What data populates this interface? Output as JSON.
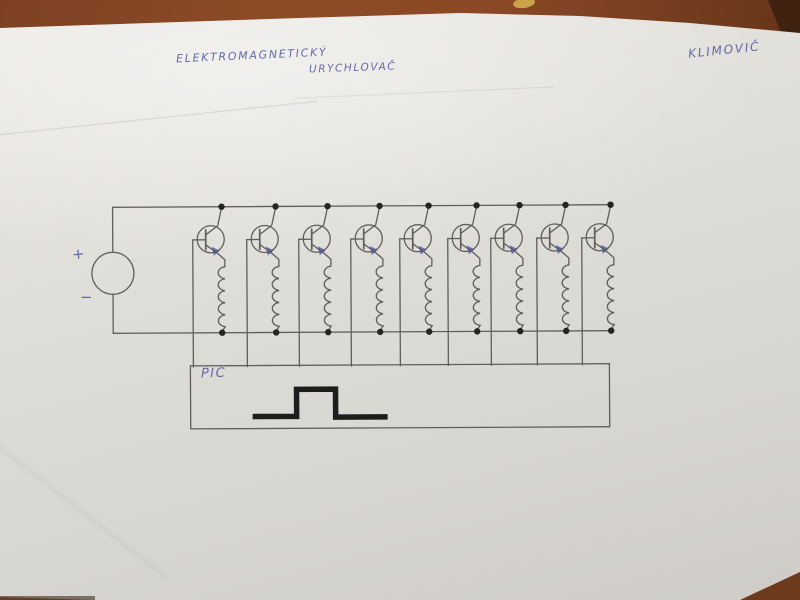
{
  "photo": {
    "title_line1": "ELEKTROMAGNETICKÝ",
    "title_line2": "URYCHLOVAČ",
    "author_signature": "KLIMOVIČ",
    "ink_color": "#4d53a0",
    "pencil_color": "#5f5e5a",
    "paper_color": "#dcdad5",
    "table_color": "#8a4a28"
  },
  "circuit": {
    "type": "hand-drawn schematic",
    "description": "DC source driving 9 parallel transistor-coil stages, bases controlled by a PIC pulse generator",
    "source": {
      "plus_label": "+",
      "minus_label": "−"
    },
    "controller_label": "PIC",
    "stage_count": 9,
    "stage_x": [
      222,
      276,
      328,
      380,
      429,
      477,
      520,
      566,
      611
    ],
    "rails": {
      "top_y": 206,
      "bottom_y": 332,
      "left_x": 113,
      "right_x": 611
    },
    "source_circle": {
      "cx": 113,
      "cy": 272,
      "r": 21
    },
    "pic_box": {
      "x": 190,
      "y": 365,
      "w": 419,
      "h": 63
    },
    "pulse_points": [
      [
        252,
        416
      ],
      [
        296,
        416
      ],
      [
        296,
        389
      ],
      [
        335,
        389
      ],
      [
        335,
        417
      ],
      [
        387,
        417
      ]
    ],
    "colors": {
      "wire": "#5f5e5a",
      "dot": "#26241f",
      "pulse": "#1d1d1d",
      "arrow_ink": "#4d53a0"
    }
  }
}
